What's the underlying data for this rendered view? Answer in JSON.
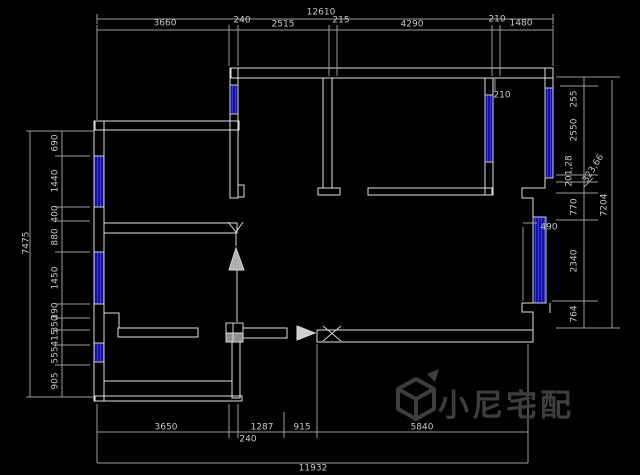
{
  "drawing": {
    "type": "floor-plan",
    "background": "#000000",
    "colors": {
      "wall_line": "#e2e2e2",
      "dim_line": "#9c9c9c",
      "dim_text": "#c9c9c9",
      "window_fill": "#12129e",
      "window_stripe": "#3a3ad8",
      "watermark": "#3e3e3e"
    },
    "dims": {
      "top": {
        "total": "12610",
        "segments": [
          "3660",
          "240",
          "2515",
          "215",
          "4290",
          "210",
          "1480"
        ]
      },
      "bottom": {
        "total": "11932",
        "segments": [
          "3650",
          "240",
          "1287",
          "915",
          "5840"
        ]
      },
      "left": {
        "total": "7475",
        "segments": [
          "690",
          "1440",
          "400",
          "880",
          "1450",
          "390",
          "350",
          "415",
          "555",
          "905"
        ]
      },
      "right": {
        "total": "7204",
        "segments": [
          "255",
          "2550",
          "201,28",
          "323,66",
          "770",
          "2340",
          "764"
        ]
      },
      "annotations": {
        "wall_210": "210",
        "window_490": "490"
      }
    },
    "watermark": {
      "text": "小尼宅配",
      "logo": "cube-logo"
    }
  }
}
